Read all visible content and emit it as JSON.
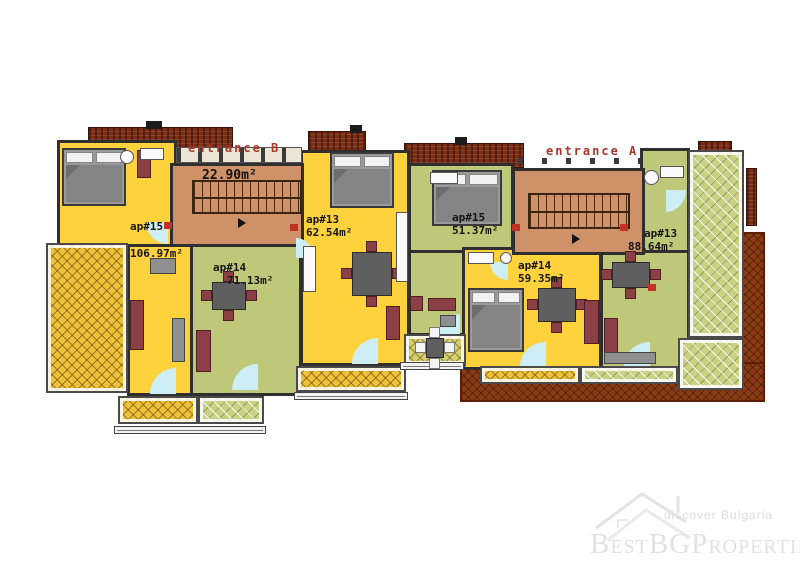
{
  "plan": {
    "entrances": [
      {
        "label": "entrance B"
      },
      {
        "label": "entrance A"
      }
    ],
    "stairwell": {
      "area": "22.90m²"
    },
    "apartments": [
      {
        "id": "ap#15",
        "area": "106.97m²"
      },
      {
        "id": "ap#14",
        "area": "71.13m²"
      },
      {
        "id": "ap#13",
        "area": "62.54m²"
      },
      {
        "id": "ap#15",
        "area": "51.37m²"
      },
      {
        "id": "ap#14",
        "area": "59.35m²"
      },
      {
        "id": "ap#13",
        "area": "88.64m²"
      }
    ]
  },
  "watermark": {
    "tagline": "discover Bulgaria",
    "brand": "BestBGProperties"
  },
  "palette": {
    "apartment_yellow": "#fdd23c",
    "apartment_green": "#bfc878",
    "stair_core_tan": "#cf9168",
    "roof_dark_red": "#7c2c12",
    "ground_brown": "#8a3a15",
    "terrace_green_hatch": "#c8d184",
    "terrace_yellow_hatch": "#edc23a",
    "entrance_label_red": "#a8372c",
    "wall": "#2f2f2f",
    "door_cyan": "#cdeef4",
    "furniture_maroon": "#8c4046",
    "furniture_gray": "#5f5f5f",
    "watermark_gray": "#e2e2e2"
  }
}
